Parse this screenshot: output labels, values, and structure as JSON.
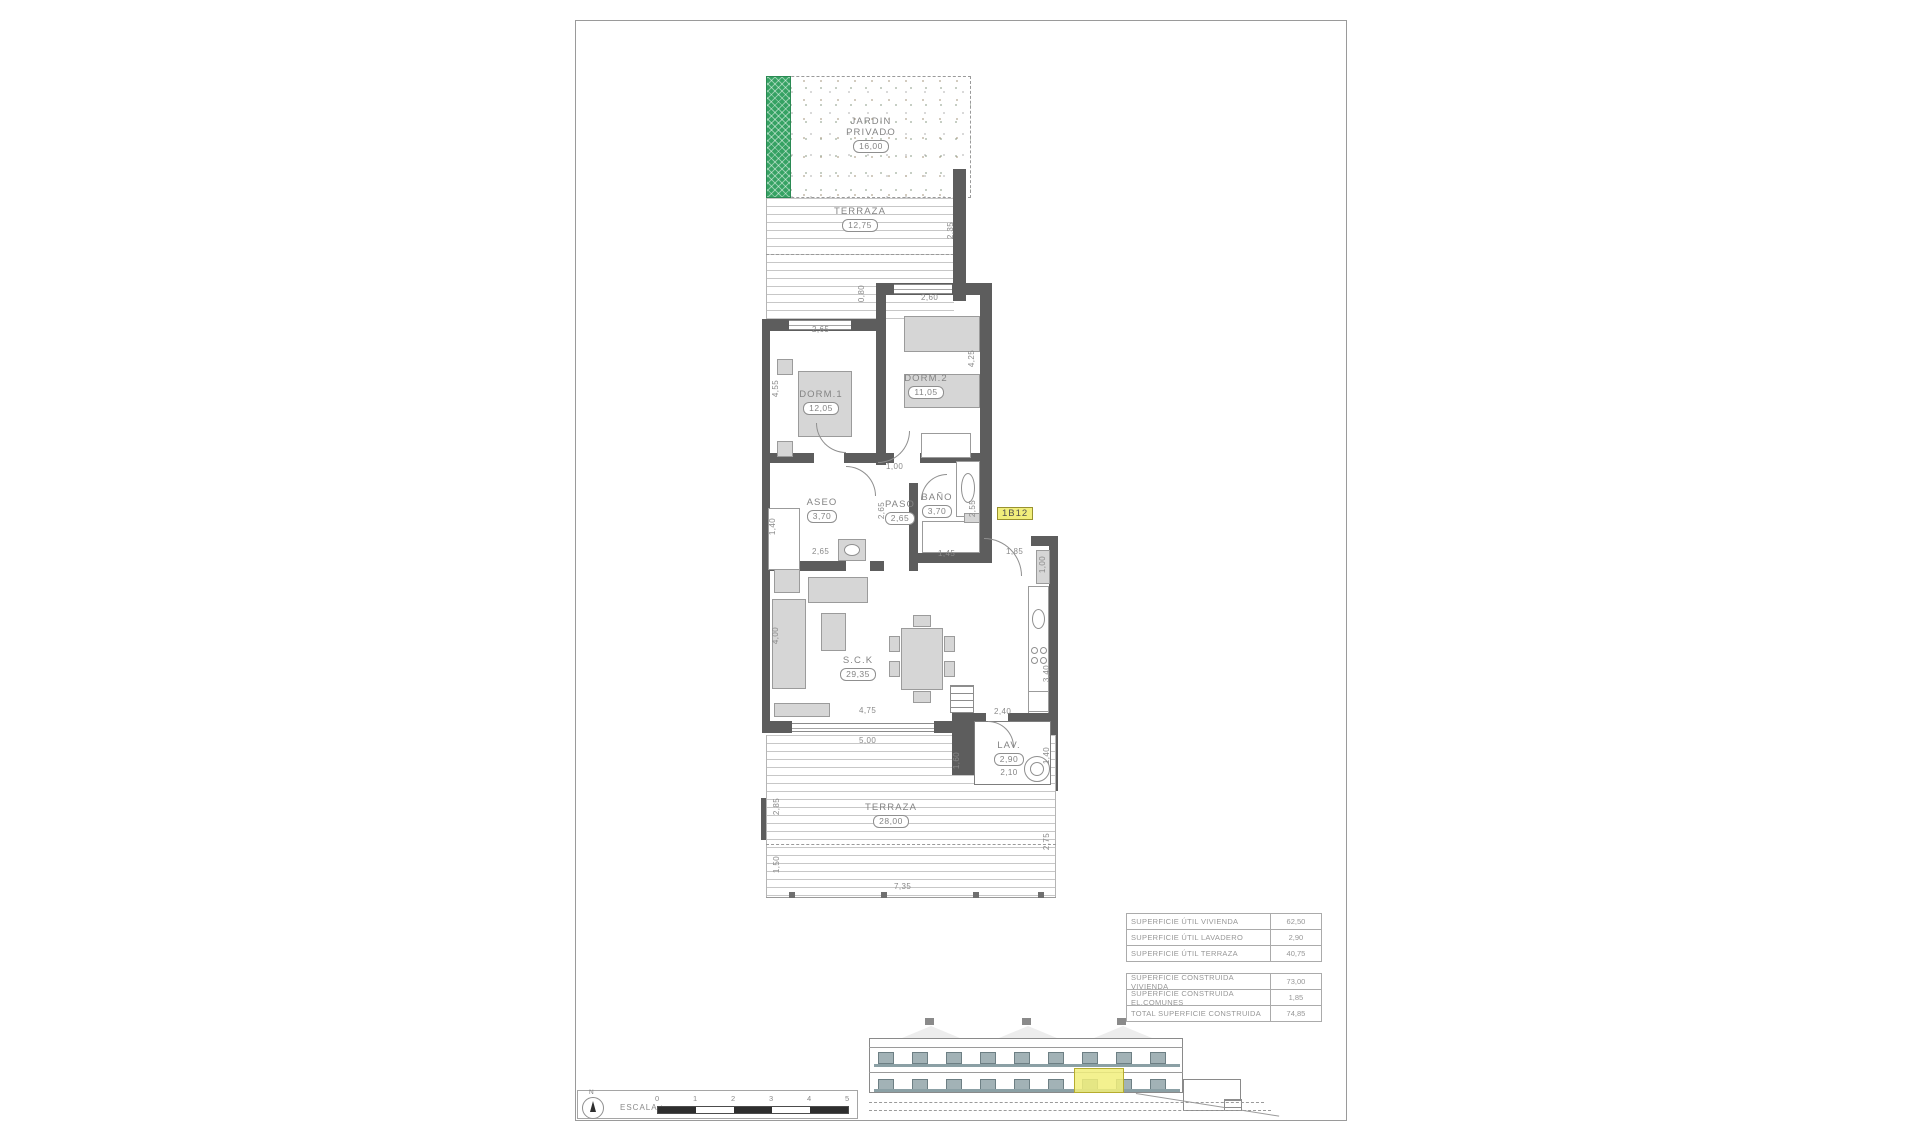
{
  "colors": {
    "wall": "#5d5d5d",
    "highlight": "#f1ee7b",
    "garden_green": "#35a263",
    "railing": "#8ba0a5"
  },
  "unit": {
    "code": "1B12"
  },
  "rooms": {
    "jardin": {
      "label": "JARDIN PRIVADO",
      "area": "16,00"
    },
    "terraza_sup": {
      "label": "TERRAZA",
      "area": "12,75"
    },
    "dorm1": {
      "label": "DORM.1",
      "area": "12,05"
    },
    "dorm2": {
      "label": "DORM.2",
      "area": "11,05"
    },
    "aseo": {
      "label": "ASEO",
      "area": "3,70"
    },
    "paso": {
      "label": "PASO",
      "area": "2,65"
    },
    "bano": {
      "label": "BAÑO",
      "area": "3,70"
    },
    "sck": {
      "label": "S.C.K",
      "area": "29,35"
    },
    "lav": {
      "label": "LAV.",
      "area": "2,90",
      "area2": "2,10"
    },
    "terraza_inf": {
      "label": "TERRAZA",
      "area": "28,00"
    }
  },
  "dims": {
    "dorm1_top": "2,65",
    "dorm1_left": "4,55",
    "dorm2_top": "2,60",
    "dorm2_right": "4,25",
    "terraza_sup_right": "2,35",
    "porch": "0,80",
    "paso_top": "1,00",
    "aseo_left": "1,40",
    "aseo_bottom": "2,65",
    "paso_side": "2,65",
    "bano_right": "2,55",
    "bano_bottom": "1,45",
    "entry": "1,85",
    "entry_closet": "1,00",
    "sck_left": "4,00",
    "sck_width": "4,75",
    "sck_width_ext": "5,00",
    "sck_kitchen": "2,40",
    "kitchen_right": "3,40",
    "lav_left": "1,60",
    "lav_right": "1,40",
    "terraza_inf_left_a": "2,85",
    "terraza_inf_left_b": "1,50",
    "terraza_inf_right": "2,75",
    "terraza_inf_width": "7,35"
  },
  "tables": {
    "util": {
      "rows": [
        {
          "label": "SUPERFICIE ÚTIL VIVIENDA",
          "value": "62,50"
        },
        {
          "label": "SUPERFICIE ÚTIL LAVADERO",
          "value": "2,90"
        },
        {
          "label": "SUPERFICIE ÚTIL TERRAZA",
          "value": "40,75"
        }
      ]
    },
    "construida": {
      "rows": [
        {
          "label": "SUPERFICIE CONSTRUIDA VIVIENDA",
          "value": "73,00"
        },
        {
          "label": "SUPERFICIE CONSTRUIDA EL.COMUNES",
          "value": "1,85"
        },
        {
          "label": "TOTAL SUPERFICIE CONSTRUIDA",
          "value": "74,85"
        }
      ]
    }
  },
  "scale": {
    "label": "ESCALA :",
    "north": "N",
    "ticks": [
      "0",
      "1",
      "2",
      "3",
      "4",
      "5"
    ]
  }
}
